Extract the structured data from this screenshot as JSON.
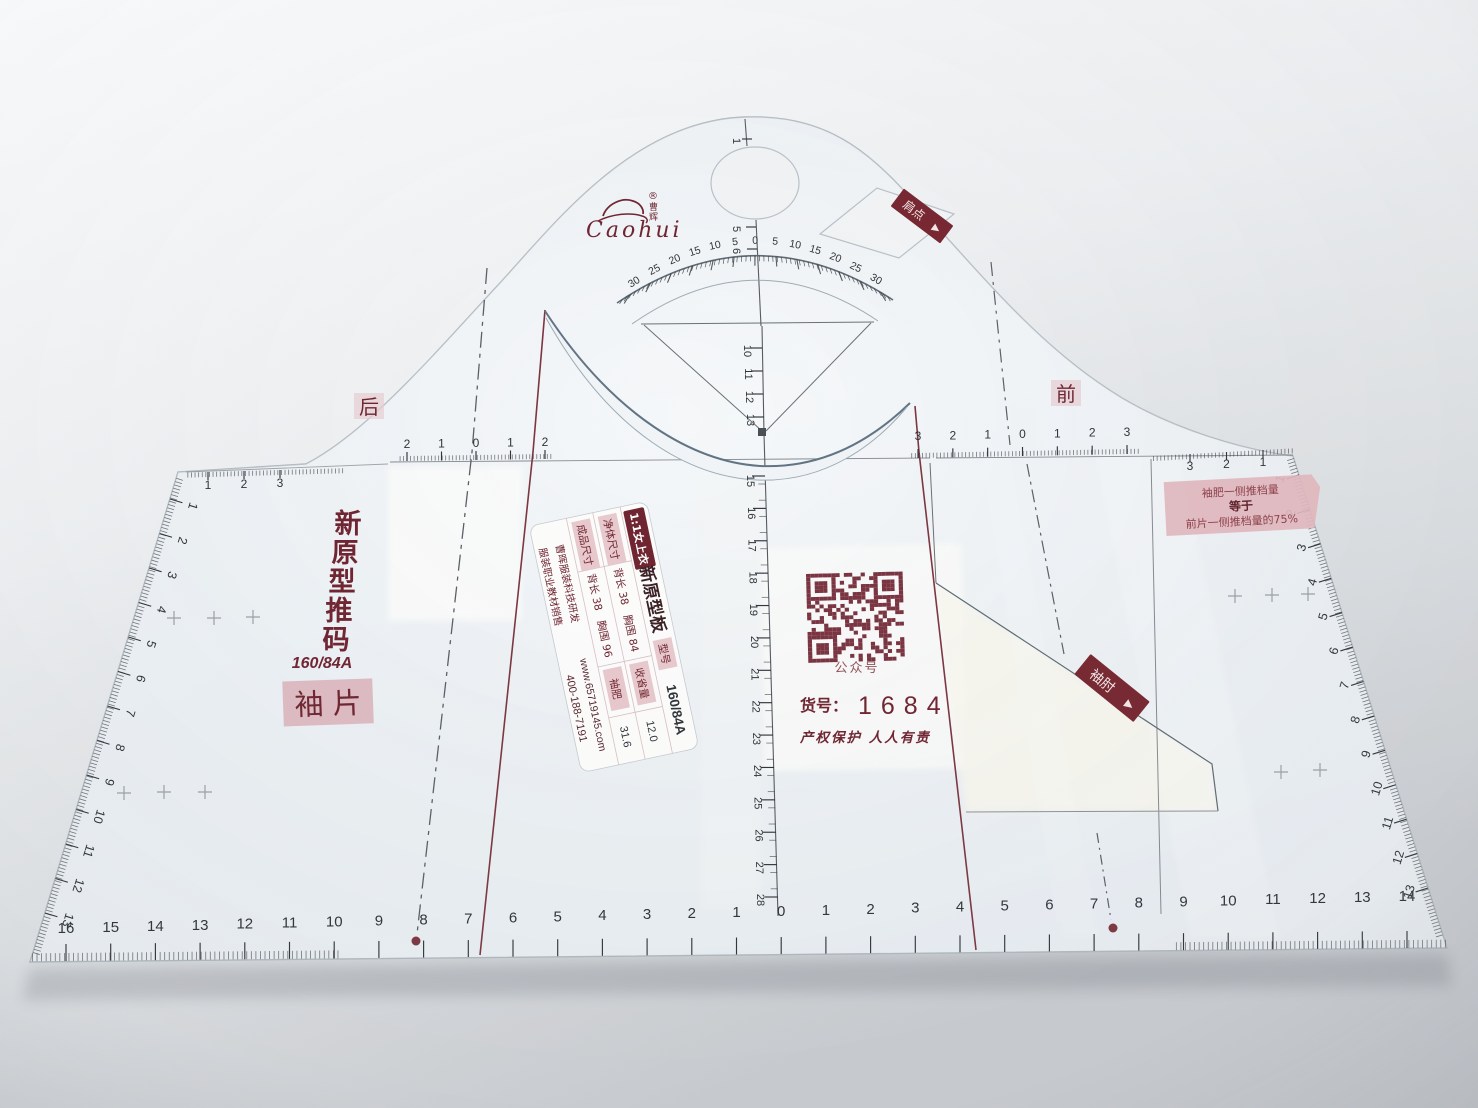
{
  "product": {
    "brand_script": "Caohui",
    "brand_reg": "®",
    "brand_char_top": "曹",
    "brand_char_bottom": "辉",
    "back": "后",
    "front": "前",
    "shoulder_tag": "肩点",
    "shoulder_arrow": "▶",
    "elbow_tag": "袖肘",
    "elbow_arrow": "▶",
    "title_vertical": [
      "新",
      "原",
      "型",
      "推",
      "码"
    ],
    "size_code": "160/84A",
    "piece_badge": "袖 片",
    "qr_caption": "公众号",
    "item_label": "货号：",
    "item_value": "1684",
    "slogan": "产权保护  人人有责",
    "note1": "袖肥一侧推档量",
    "note2": "等于",
    "note3": "前片一侧推档量的75%"
  },
  "spec_label": {
    "badge": "1:1女上衣",
    "title": "新原型板",
    "model_k": "型号",
    "model_v": "160/84A",
    "r2": [
      "净体尺寸",
      "背长 38",
      "胸围 84",
      "收省量",
      "12.0"
    ],
    "r3": [
      "成品尺寸",
      "背长 38",
      "胸围 96",
      "袖肥",
      "31.6"
    ],
    "dev": "曹晖服装科技研发",
    "site": "www.65719145.com",
    "sales": "服装职业教材销售",
    "phone": "400-188-7191"
  },
  "rulers": {
    "bottom": [
      "16",
      "15",
      "14",
      "13",
      "12",
      "11",
      "10",
      "9",
      "8",
      "7",
      "6",
      "5",
      "4",
      "3",
      "2",
      "1",
      "0",
      "1",
      "2",
      "3",
      "4",
      "5",
      "6",
      "7",
      "8",
      "9",
      "10",
      "11",
      "12",
      "13",
      "14"
    ],
    "left_edge": [
      "1",
      "2",
      "3",
      "4",
      "5",
      "6",
      "7",
      "8",
      "9",
      "10",
      "11",
      "12",
      "13"
    ],
    "right_edge": [
      "1",
      "2",
      "3",
      "4",
      "5",
      "6",
      "7",
      "8",
      "9",
      "10",
      "11",
      "12",
      "13"
    ],
    "top_left": [
      "1",
      "2",
      "3"
    ],
    "left_mini": [
      "2",
      "1",
      "0",
      "1",
      "2"
    ],
    "right_mini": [
      "3",
      "2",
      "1",
      "0",
      "1",
      "2",
      "3"
    ],
    "top_right": [
      "3",
      "2",
      "1"
    ],
    "center_top": [
      "1",
      "5",
      "6"
    ],
    "center_a": [
      "10",
      "11",
      "12",
      "13"
    ],
    "center_b": [
      "15",
      "16",
      "17",
      "18",
      "19",
      "20",
      "21",
      "22",
      "23",
      "24",
      "25",
      "26",
      "27",
      "28"
    ],
    "protractor": [
      "30",
      "25",
      "20",
      "15",
      "10",
      "5",
      "0",
      "5",
      "10",
      "15",
      "20",
      "25",
      "30"
    ]
  },
  "colors": {
    "dark_red": "#6f2430",
    "line_red": "#7c3640",
    "pink_label": "#e2b8be",
    "plastic": "#e9eef2",
    "qr": "#7a3340"
  }
}
